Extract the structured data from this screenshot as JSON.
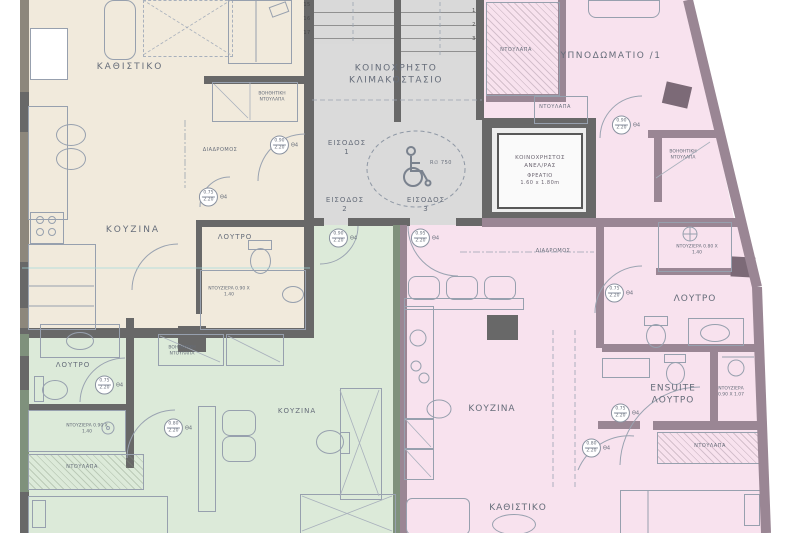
{
  "plan": {
    "common_areas": {
      "stairwell_line1": "ΚΟΙΝΟΧΡΗΣΤΟ",
      "stairwell_line2": "ΚΛΙΜΑΚΟΣΤΑΣΙΟ",
      "entrances": [
        {
          "label": "ΕΙΣΟΔΟΣ",
          "number": "1"
        },
        {
          "label": "ΕΙΣΟΔΟΣ",
          "number": "2"
        },
        {
          "label": "ΕΙΣΟΔΟΣ",
          "number": "3"
        }
      ],
      "turning_circle": "R∅ 750",
      "stair_steps_left": [
        "15",
        "16",
        "17"
      ],
      "stair_steps_right": [
        "1",
        "2",
        "3"
      ],
      "elevator": {
        "line1": "ΚΟΙΝΟΧΡΗΣΤΟΣ",
        "line2": "ΑΝΕΛ/ΡΑΣ",
        "line3": "ΦΡΕΑΤΙΟ",
        "line4": "1.60 x 1.80m"
      }
    },
    "studio_top_left": {
      "living": "ΚΑΘΙΣΤΙΚΟ",
      "kitchen": "ΚΟΥΖΙΝΑ",
      "bath": "ΛΟΥΤΡΟ",
      "hall": "ΔΙΑΔΡΟΜΟΣ",
      "aux_closet": "ΒΟΗΘΗΤΙΚΗ ΝΤΟΥΛΑΠΑ",
      "shower": "ΝΤΟΥΖΙΕΡΑ 0.90 Χ 1.40"
    },
    "studio_bottom_left": {
      "bath": "ΛΟΥΤΡΟ",
      "kitchen": "ΚΟΥΖΙΝΑ",
      "shower": "ΝΤΟΥΖΙΕΡΑ 0.90 Χ 1.40",
      "closet": "ΝΤΟΥΛΑΠΑ",
      "aux_closet": "ΒΟΗΘΗΤΙΚΗ ΝΤΟΥΛΑΠΑ"
    },
    "apartment_right": {
      "bedroom1": "ΥΠΝΟΔΩΜΑΤΙΟ /1",
      "bath": "ΛΟΥΤΡΟ",
      "bath_shower": "ΝΤΟΥΖΙΕΡΑ 0.80 Χ 1.40",
      "ensuite_line1": "ENSUITE",
      "ensuite_line2": "ΛΟΥΤΡΟ",
      "ensuite_shower": "ΝΤΟΥΖΙΕΡΑ 0.90 Χ 1.07",
      "kitchen": "ΚΟΥΖΙΝΑ",
      "living": "ΚΑΘΙΣΤΙΚΟ",
      "hall": "ΔΙΑΔΡΟΜΟΣ",
      "closet_top": "ΝΤΟΥΛΑΠΑ",
      "closet_mid": "ΝΤΟΥΛΑΠΑ",
      "closet_bottom": "ΝΤΟΥΛΑΠΑ",
      "aux_closet": "ΒΟΗΘΗΤΙΚΗ ΝΤΟΥΛΑΠΑ"
    },
    "doors": [
      {
        "w": "0.90",
        "h": "2.20",
        "tag": "Θ4"
      },
      {
        "w": "0.75",
        "h": "2.20",
        "tag": "Θ4"
      },
      {
        "w": "0.90",
        "h": "2.20",
        "tag": "Θ4"
      },
      {
        "w": "0.95",
        "h": "2.20",
        "tag": "Θ4"
      },
      {
        "w": "0.90",
        "h": "2.20",
        "tag": "Θ4"
      },
      {
        "w": "0.75",
        "h": "2.20",
        "tag": "Θ4"
      },
      {
        "w": "0.75",
        "h": "2.20",
        "tag": "Θ4"
      },
      {
        "w": "0.80",
        "h": "2.20",
        "tag": "Θ4"
      },
      {
        "w": "0.75",
        "h": "2.20",
        "tag": "Θ4"
      },
      {
        "w": "0.80",
        "h": "2.20",
        "tag": "Θ4"
      }
    ]
  },
  "colors": {
    "studio_top_left_fill": "#f1eadc",
    "studio_bottom_left_fill": "#dcead9",
    "apartment_right_fill": "#f8e2ee",
    "common_fill": "#dadada",
    "wall_dark": "#686868",
    "wall_right_apartment": "#9a8694",
    "wall_green": "#7f917c",
    "wall_beige": "#8d877c",
    "furniture_line": "#97a0ae",
    "text": "#666d7a"
  }
}
